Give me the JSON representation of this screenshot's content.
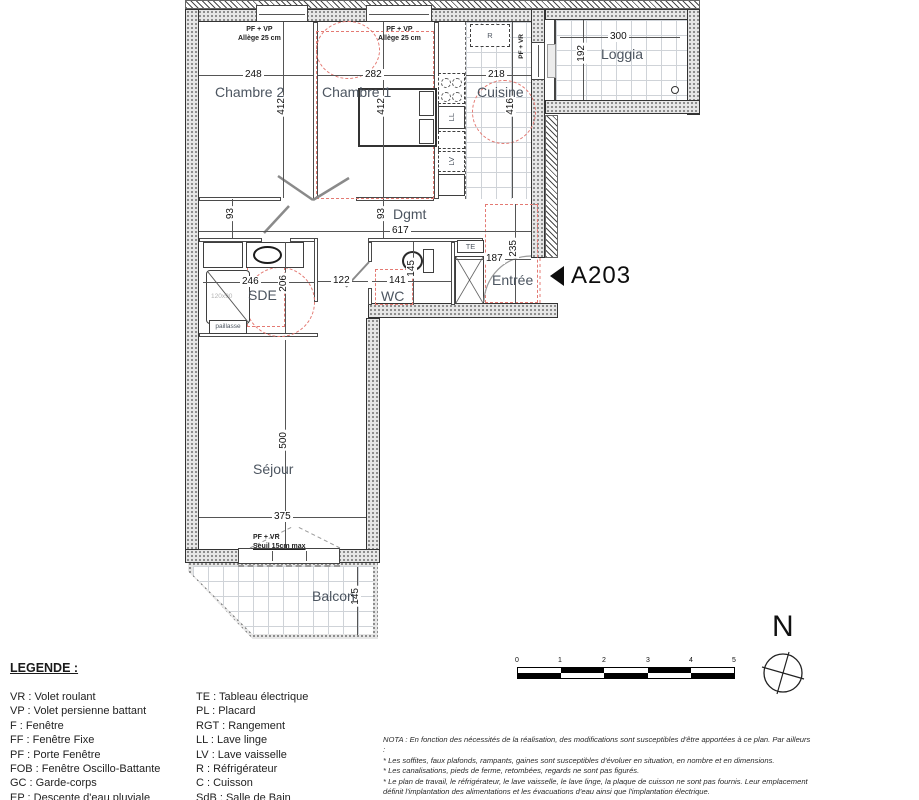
{
  "unit": "A203",
  "north": "N",
  "labels": {
    "chambre2": "Chambre 2",
    "chambre1": "Chambre 1",
    "cuisine": "Cuisine",
    "loggia": "Loggia",
    "dgmt": "Dgmt",
    "sde": "SDE",
    "wc": "WC",
    "entree": "Entrée",
    "sejour": "Séjour",
    "balcon": "Balcon"
  },
  "dims": {
    "ch2_w": "248",
    "ch2_h": "412",
    "ch1_w": "282",
    "ch1_h": "412",
    "cuisine_w": "218",
    "cuisine_h": "416",
    "loggia_w": "300",
    "loggia_h": "192",
    "corr_off1": "93",
    "corr_off2": "93",
    "corr_w": "617",
    "sde_w": "246",
    "sde_h": "206",
    "pass_w": "122",
    "wc_w": "141",
    "wc_h": "145",
    "entree_w": "187",
    "entree_h": "235",
    "sejour_w": "375",
    "sejour_h": "500",
    "balcon_d": "145"
  },
  "notes": {
    "window": "PF + VP",
    "allege": "Allège 25 cm",
    "loggia_door": "PF + VR",
    "sejour_door": "PF + VR",
    "seuil": "Seuil 15cm max"
  },
  "fixtures": {
    "te": "TE",
    "r": "R",
    "ll": "LL",
    "lv": "LV",
    "paillasse": "paillasse",
    "shower_size": "120x90"
  },
  "legend": {
    "title": "LEGENDE :",
    "col1": [
      "VR : Volet roulant",
      "VP : Volet persienne battant",
      "F : Fenêtre",
      "FF : Fenêtre Fixe",
      "PF : Porte Fenêtre",
      "FOB : Fenêtre Oscillo-Battante",
      "GC : Garde-corps",
      "EP : Descente d'eau pluviale"
    ],
    "soffite_item": ": Soffite",
    "col2": [
      "TE : Tableau électrique",
      "PL : Placard",
      "RGT : Rangement",
      "LL : Lave linge",
      "LV : Lave vaisselle",
      "R : Réfrigérateur",
      "C : Cuisson",
      "SdB : Salle de Bain"
    ]
  },
  "scalebar": {
    "ticks": [
      "0",
      "1",
      "2",
      "3",
      "4",
      "5"
    ]
  },
  "nota": [
    "NOTA : En fonction des nécessités de la réalisation, des modifications sont susceptibles d'être apportées à ce plan. Par ailleurs",
    ":",
    "* Les soffites, faux plafonds, rampants, gaines sont susceptibles d'évoluer en situation, en nombre et en dimensions.",
    "* Les canalisations, pieds de ferme, retombées, regards ne sont pas figurés.",
    "* Le plan de travail, le réfrigérateur, le lave vaisselle, le lave linge, la plaque de cuisson ne sont pas fournis. Leur emplacement",
    "définit l'implantation des alimentations et les évacuations d'eau ainsi que l'implantation électrique."
  ]
}
